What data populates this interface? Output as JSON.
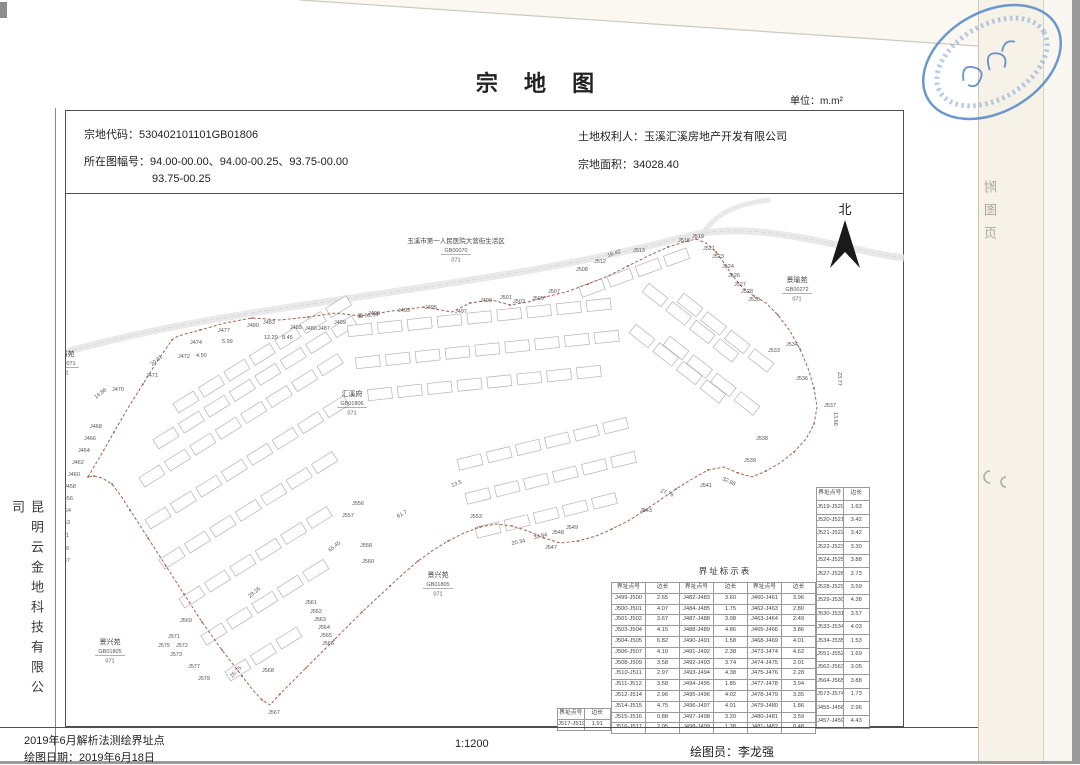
{
  "page": {
    "title": "宗 地 图",
    "unit_label": "单位：m.m²"
  },
  "header": {
    "parcel_code_label": "宗地代码：",
    "parcel_code": "530402101101GB01806",
    "sheet_no_label": "所在图幅号：",
    "sheet_no_line1": "94.00-00.00、94.00-00.25、93.75-00.00",
    "sheet_no_line2": "93.75-00.25",
    "owner_label": "土地权利人：",
    "owner": "玉溪汇溪房地产开发有限公司",
    "area_label": "宗地面积：",
    "area": "34028.40"
  },
  "side": {
    "company_vertical": "昆明云金地科技有限公司",
    "back_page_vertical": "附图页"
  },
  "footer": {
    "line1": "2019年6月解析法测绘界址点",
    "line2": "绘图日期：2019年6月18日",
    "scale": "1:1200",
    "drafter": "绘图员：李龙强"
  },
  "map": {
    "north_label": "北",
    "area_labels": [
      {
        "name": "玉溪市第一人民医院大营街生活区",
        "code": "GB00070",
        "num": "071",
        "x": 456,
        "y": 243,
        "nf": 6.5
      },
      {
        "name": "景瑜苑",
        "code": "GB00272",
        "num": "071",
        "x": 797,
        "y": 282,
        "nf": 7
      },
      {
        "name": "景裕苑",
        "code": "GB00071",
        "num": "071",
        "x": 64,
        "y": 356,
        "nf": 7
      },
      {
        "name": "汇溪府",
        "code": "GB01806",
        "num": "071",
        "x": 352,
        "y": 396,
        "nf": 7
      },
      {
        "name": "景兴苑",
        "code": "GB01805",
        "num": "071",
        "x": 438,
        "y": 577,
        "nf": 7
      },
      {
        "name": "景兴苑",
        "code": "GB01805",
        "num": "071",
        "x": 110,
        "y": 644,
        "nf": 7
      }
    ],
    "point_labels": [
      {
        "t": "J470",
        "x": 112,
        "y": 391
      },
      {
        "t": "14.86",
        "x": 96,
        "y": 399,
        "r": -38
      },
      {
        "t": "J471",
        "x": 146,
        "y": 377
      },
      {
        "t": "20.01",
        "x": 152,
        "y": 366,
        "r": -38
      },
      {
        "t": "J472",
        "x": 178,
        "y": 358
      },
      {
        "t": "4.50",
        "x": 196,
        "y": 357
      },
      {
        "t": "J474",
        "x": 190,
        "y": 344
      },
      {
        "t": "5.99",
        "x": 222,
        "y": 343
      },
      {
        "t": "J477",
        "x": 218,
        "y": 332
      },
      {
        "t": "J480",
        "x": 247,
        "y": 327
      },
      {
        "t": "J483",
        "x": 263,
        "y": 324
      },
      {
        "t": "12.29",
        "x": 264,
        "y": 339
      },
      {
        "t": "8.45",
        "x": 282,
        "y": 339
      },
      {
        "t": "J485",
        "x": 290,
        "y": 329
      },
      {
        "t": "J486",
        "x": 305,
        "y": 330
      },
      {
        "t": "J487",
        "x": 318,
        "y": 330
      },
      {
        "t": "J489",
        "x": 334,
        "y": 324
      },
      {
        "t": "路 53.39",
        "x": 358,
        "y": 318,
        "r": -6
      },
      {
        "t": "J490",
        "x": 368,
        "y": 315
      },
      {
        "t": "J493",
        "x": 398,
        "y": 312
      },
      {
        "t": "J495",
        "x": 425,
        "y": 309
      },
      {
        "t": "J497",
        "x": 455,
        "y": 313
      },
      {
        "t": "J499",
        "x": 480,
        "y": 302
      },
      {
        "t": "J501",
        "x": 500,
        "y": 299
      },
      {
        "t": "J503",
        "x": 513,
        "y": 303
      },
      {
        "t": "J505",
        "x": 532,
        "y": 300
      },
      {
        "t": "J507",
        "x": 548,
        "y": 293
      },
      {
        "t": "J508",
        "x": 576,
        "y": 271
      },
      {
        "t": "16.42",
        "x": 608,
        "y": 257,
        "r": -18
      },
      {
        "t": "J512",
        "x": 594,
        "y": 263
      },
      {
        "t": "J513",
        "x": 633,
        "y": 252
      },
      {
        "t": "J518",
        "x": 678,
        "y": 242
      },
      {
        "t": "J519",
        "x": 692,
        "y": 238
      },
      {
        "t": "J521",
        "x": 703,
        "y": 250
      },
      {
        "t": "J523",
        "x": 712,
        "y": 258
      },
      {
        "t": "J524",
        "x": 722,
        "y": 268
      },
      {
        "t": "J526",
        "x": 728,
        "y": 277
      },
      {
        "t": "J527",
        "x": 734,
        "y": 286
      },
      {
        "t": "J528",
        "x": 741,
        "y": 293
      },
      {
        "t": "J530",
        "x": 748,
        "y": 301
      },
      {
        "t": "J533",
        "x": 768,
        "y": 352
      },
      {
        "t": "J534",
        "x": 786,
        "y": 346
      },
      {
        "t": "J536",
        "x": 796,
        "y": 380
      },
      {
        "t": "23.77",
        "x": 838,
        "y": 372,
        "r": 90
      },
      {
        "t": "13.66",
        "x": 834,
        "y": 412,
        "r": 90
      },
      {
        "t": "J537",
        "x": 824,
        "y": 407
      },
      {
        "t": "J538",
        "x": 756,
        "y": 440
      },
      {
        "t": "J539",
        "x": 744,
        "y": 462
      },
      {
        "t": "32.98",
        "x": 722,
        "y": 480,
        "r": 25
      },
      {
        "t": "J541",
        "x": 700,
        "y": 487
      },
      {
        "t": "27.76",
        "x": 660,
        "y": 492,
        "r": 20
      },
      {
        "t": "J543",
        "x": 640,
        "y": 512
      },
      {
        "t": "J547",
        "x": 545,
        "y": 549
      },
      {
        "t": "20.34",
        "x": 512,
        "y": 545,
        "r": -12
      },
      {
        "t": "35.84",
        "x": 534,
        "y": 539,
        "r": -12
      },
      {
        "t": "J548",
        "x": 552,
        "y": 534
      },
      {
        "t": "J549",
        "x": 566,
        "y": 529
      },
      {
        "t": "J553",
        "x": 470,
        "y": 518
      },
      {
        "t": "13.5",
        "x": 452,
        "y": 487,
        "r": -20
      },
      {
        "t": "61.7",
        "x": 398,
        "y": 518,
        "r": -28
      },
      {
        "t": "J556",
        "x": 352,
        "y": 505
      },
      {
        "t": "J557",
        "x": 342,
        "y": 517
      },
      {
        "t": "J558",
        "x": 360,
        "y": 547
      },
      {
        "t": "J560",
        "x": 362,
        "y": 563
      },
      {
        "t": "65.45",
        "x": 330,
        "y": 552,
        "r": -38
      },
      {
        "t": "J561",
        "x": 305,
        "y": 604
      },
      {
        "t": "J562",
        "x": 310,
        "y": 613
      },
      {
        "t": "J563",
        "x": 314,
        "y": 621
      },
      {
        "t": "J564",
        "x": 318,
        "y": 629
      },
      {
        "t": "J565",
        "x": 320,
        "y": 637
      },
      {
        "t": "J566",
        "x": 322,
        "y": 645
      },
      {
        "t": "29.26",
        "x": 250,
        "y": 598,
        "r": -40
      },
      {
        "t": "J568",
        "x": 262,
        "y": 672
      },
      {
        "t": "25.75",
        "x": 232,
        "y": 678,
        "r": -45
      },
      {
        "t": "J567",
        "x": 268,
        "y": 714
      },
      {
        "t": "J569",
        "x": 180,
        "y": 622
      },
      {
        "t": "J571",
        "x": 168,
        "y": 638
      },
      {
        "t": "J572",
        "x": 176,
        "y": 647
      },
      {
        "t": "J573",
        "x": 170,
        "y": 656
      },
      {
        "t": "J575",
        "x": 158,
        "y": 647
      },
      {
        "t": "J577",
        "x": 188,
        "y": 668
      },
      {
        "t": "J579",
        "x": 198,
        "y": 680
      },
      {
        "t": "J468",
        "x": 90,
        "y": 428
      },
      {
        "t": "J466",
        "x": 84,
        "y": 440
      },
      {
        "t": "J464",
        "x": 78,
        "y": 452
      },
      {
        "t": "J462",
        "x": 72,
        "y": 464
      },
      {
        "t": "J460",
        "x": 68,
        "y": 476
      },
      {
        "t": "J458",
        "x": 64,
        "y": 488
      },
      {
        "t": "J456",
        "x": 61,
        "y": 500
      },
      {
        "t": "J454",
        "x": 59,
        "y": 512
      },
      {
        "t": "J453",
        "x": 58,
        "y": 524
      },
      {
        "t": "J451",
        "x": 57,
        "y": 537
      },
      {
        "t": "J449",
        "x": 57,
        "y": 550
      },
      {
        "t": "J447",
        "x": 58,
        "y": 562
      }
    ]
  },
  "boundary_table": {
    "title": "界址标示表",
    "col_point": "界址点号",
    "col_len": "边长",
    "main_rows": [
      [
        "J499-J500",
        "2.65",
        "J482-J483",
        "3.60",
        "J460-J461",
        "3.96"
      ],
      [
        "J500-J501",
        "4.07",
        "J484-J485",
        "1.75",
        "J462-J463",
        "2.80"
      ],
      [
        "J501-J502",
        "3.67",
        "J487-J488",
        "3.08",
        "J463-J464",
        "2.49"
      ],
      [
        "J503-J504",
        "4.15",
        "J488-J489",
        "4.86",
        "J465-J466",
        "3.86"
      ],
      [
        "J504-J505",
        "6.82",
        "J490-J491",
        "1.58",
        "J468-J469",
        "4.01"
      ],
      [
        "J506-J507",
        "4.10",
        "J491-J492",
        "2.38",
        "J473-J474",
        "4.62"
      ],
      [
        "J508-J509",
        "3.58",
        "J492-J493",
        "3.74",
        "J474-J475",
        "2.01"
      ],
      [
        "J510-J511",
        "2.97",
        "J493-J494",
        "4.38",
        "J475-J476",
        "2.28"
      ],
      [
        "J511-J512",
        "3.58",
        "J494-J495",
        "1.85",
        "J477-J478",
        "3.94"
      ],
      [
        "J512-J514",
        "2.96",
        "J495-J496",
        "4.02",
        "J478-J479",
        "3.35"
      ],
      [
        "J514-J515",
        "4.75",
        "J496-J497",
        "4.01",
        "J479-J480",
        "1.86"
      ],
      [
        "J515-J516",
        "0.88",
        "J497-J498",
        "3.20",
        "J480-J481",
        "3.59"
      ],
      [
        "J516-J517",
        "2.05",
        "J498-J499",
        "1.38",
        "J481-J482",
        "0.48"
      ]
    ],
    "right_rows": [
      [
        "J519-J520",
        "1.63"
      ],
      [
        "J520-J521",
        "3.42"
      ],
      [
        "J521-J522",
        "3.42"
      ],
      [
        "J522-J523",
        "3.30"
      ],
      [
        "J524-J525",
        "3.88"
      ],
      [
        "J527-J528",
        "2.73"
      ],
      [
        "J528-J529",
        "3.59"
      ],
      [
        "J529-J530",
        "4.38"
      ],
      [
        "J530-J531",
        "3.57"
      ],
      [
        "J533-J534",
        "4.03"
      ],
      [
        "J534-J535",
        "1.53"
      ],
      [
        "J551-J552",
        "1.69"
      ],
      [
        "J562-J563",
        "3.05"
      ],
      [
        "J564-J565",
        "3.88"
      ],
      [
        "J573-J574",
        "1.73"
      ],
      [
        "J455-J456",
        "2.96"
      ],
      [
        "J457-J459",
        "4.43"
      ]
    ],
    "extra_row": [
      "J517-J519",
      "1.91"
    ]
  },
  "colors": {
    "boundary": "#a8624a",
    "boundary_dot": "#9a5440",
    "stamp": "#5b8ec9"
  }
}
